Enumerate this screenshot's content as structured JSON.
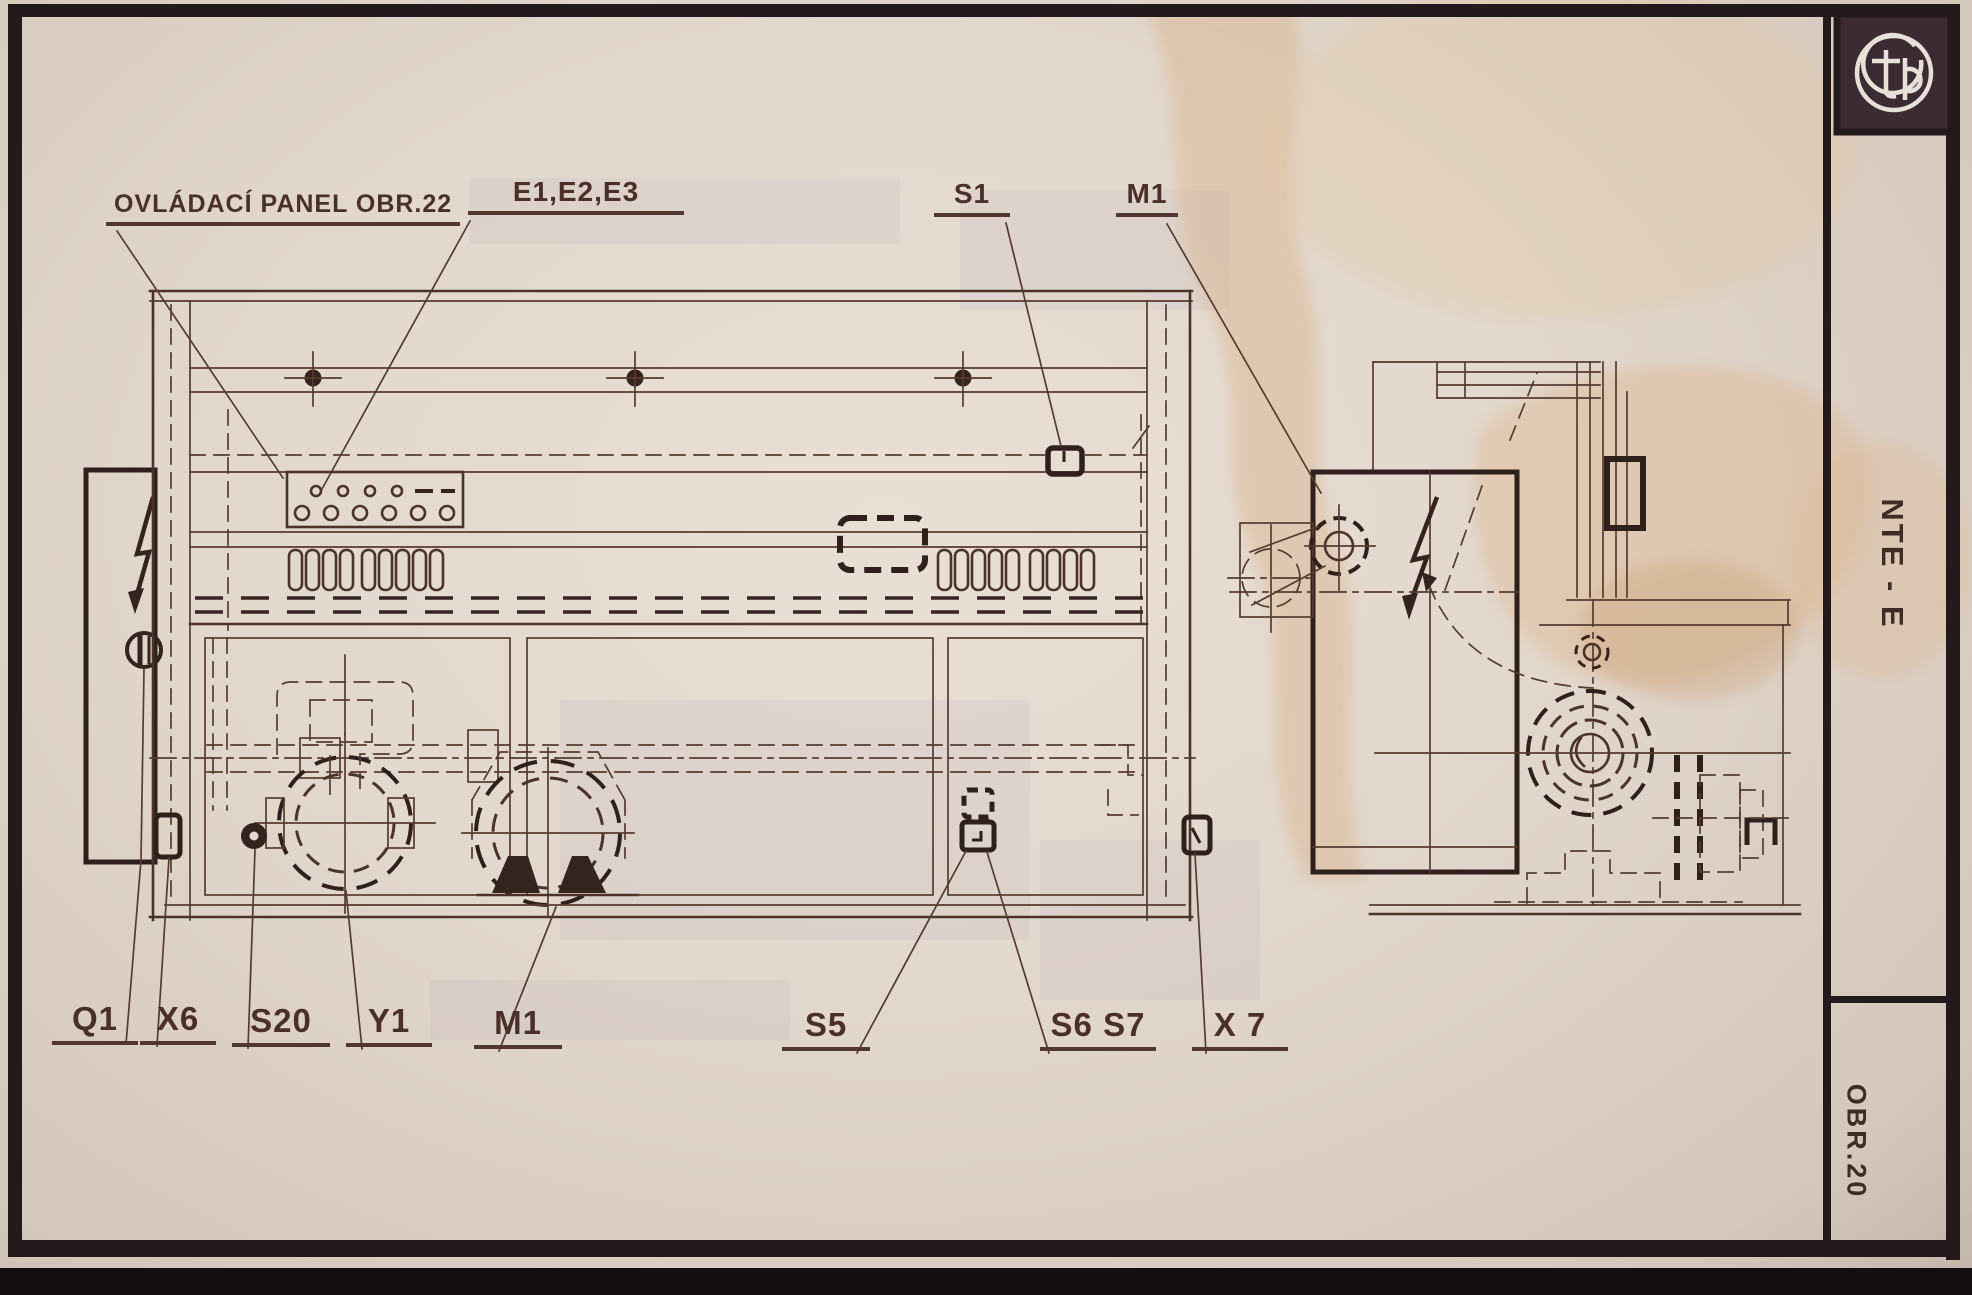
{
  "sheet": {
    "machine_model": "NTE - E",
    "figure_number": "OBR.20",
    "logo_letters": "tp"
  },
  "callouts_top": {
    "panel_note": "OVLÁDACÍ PANEL OBR.22",
    "lights": "E1,E2,E3",
    "s1": "S1",
    "m1_top": "M1"
  },
  "callouts_bottom": {
    "q1": "Q1",
    "x6": "X6",
    "s20": "S20",
    "y1": "Y1",
    "m1_bottom": "M1",
    "s5": "S5",
    "s6s7": "S6 S7",
    "x7": "X 7"
  },
  "colors": {
    "paper": "#e2d8cf",
    "ink": "#563b30",
    "bold_ink": "#30201c",
    "frame": "#241a1b",
    "stain": "#d8b088"
  }
}
